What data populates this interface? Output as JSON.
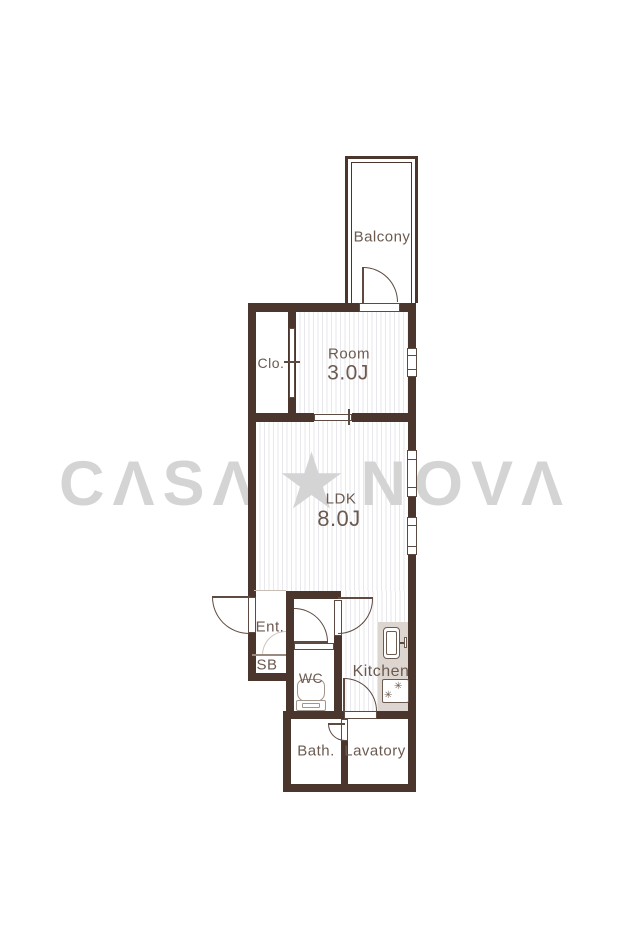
{
  "title": "apartment-floor-plan",
  "watermark": {
    "casa": "CΛSΛ",
    "star": "★",
    "nova": "NOVΛ",
    "color": "#d4d4d4"
  },
  "rooms": {
    "balcony": {
      "label": "Balcony"
    },
    "closet": {
      "label": "Clo."
    },
    "room": {
      "label": "Room",
      "size": "3.0J"
    },
    "ldk": {
      "label": "LDK",
      "size": "8.0J"
    },
    "entrance": {
      "label": "Ent."
    },
    "shoebox": {
      "label": "SB"
    },
    "wc": {
      "label": "WC"
    },
    "kitchen": {
      "label": "Kitchen"
    },
    "bath": {
      "label": "Bath."
    },
    "lavatory": {
      "label": "Lavatory"
    }
  },
  "icons": {
    "stove_burner": "✳"
  },
  "colors": {
    "wall": "#4a362d",
    "fixture_line": "#5d4a40",
    "toilet_line": "#a3958a",
    "text": "#6b5a50",
    "floor_stripe": "#e7e7ed",
    "counter": "#ddd6d0",
    "watermark": "#d4d4d4",
    "background": "#ffffff"
  }
}
